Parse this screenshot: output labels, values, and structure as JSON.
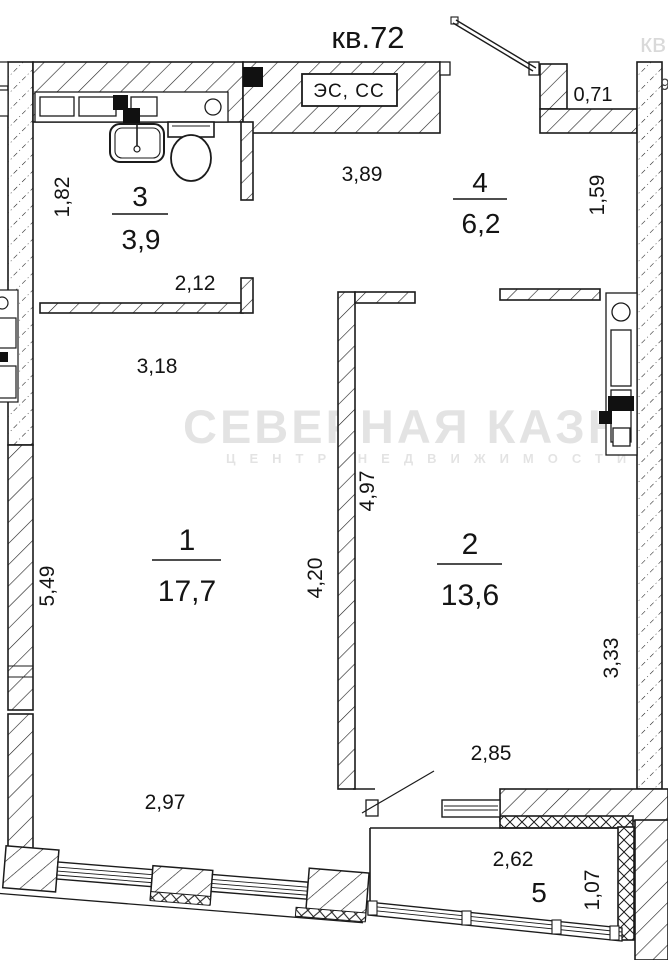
{
  "plan": {
    "title": "кв.72",
    "panel_label": "ЭС, СС",
    "rooms": [
      {
        "number": "1",
        "area": "17,7"
      },
      {
        "number": "2",
        "area": "13,6"
      },
      {
        "number": "3",
        "area": "3,9"
      },
      {
        "number": "4",
        "area": "6,2"
      },
      {
        "number": "5",
        "area": ""
      }
    ],
    "dimensions": {
      "top_niche": "0,71",
      "right_top": "1,59",
      "bath_left": "1,82",
      "hall_top": "3,89",
      "bath_partition": "2,12",
      "hall_width": "3,18",
      "room1_left": "5,49",
      "room1_right": "4,20",
      "room2_left": "4,97",
      "room2_right": "3,33",
      "room1_bottom": "2,97",
      "room2_bottom": "2,85",
      "balcony_width": "2,62",
      "balcony_depth": "1,07"
    },
    "watermark": {
      "line1": "СЕВЕРНАЯ КАЗН",
      "line2": "ЦЕНТР НЕДВИЖИМОСТИ",
      "corner": "кв",
      "edge_fragment": "9"
    }
  }
}
